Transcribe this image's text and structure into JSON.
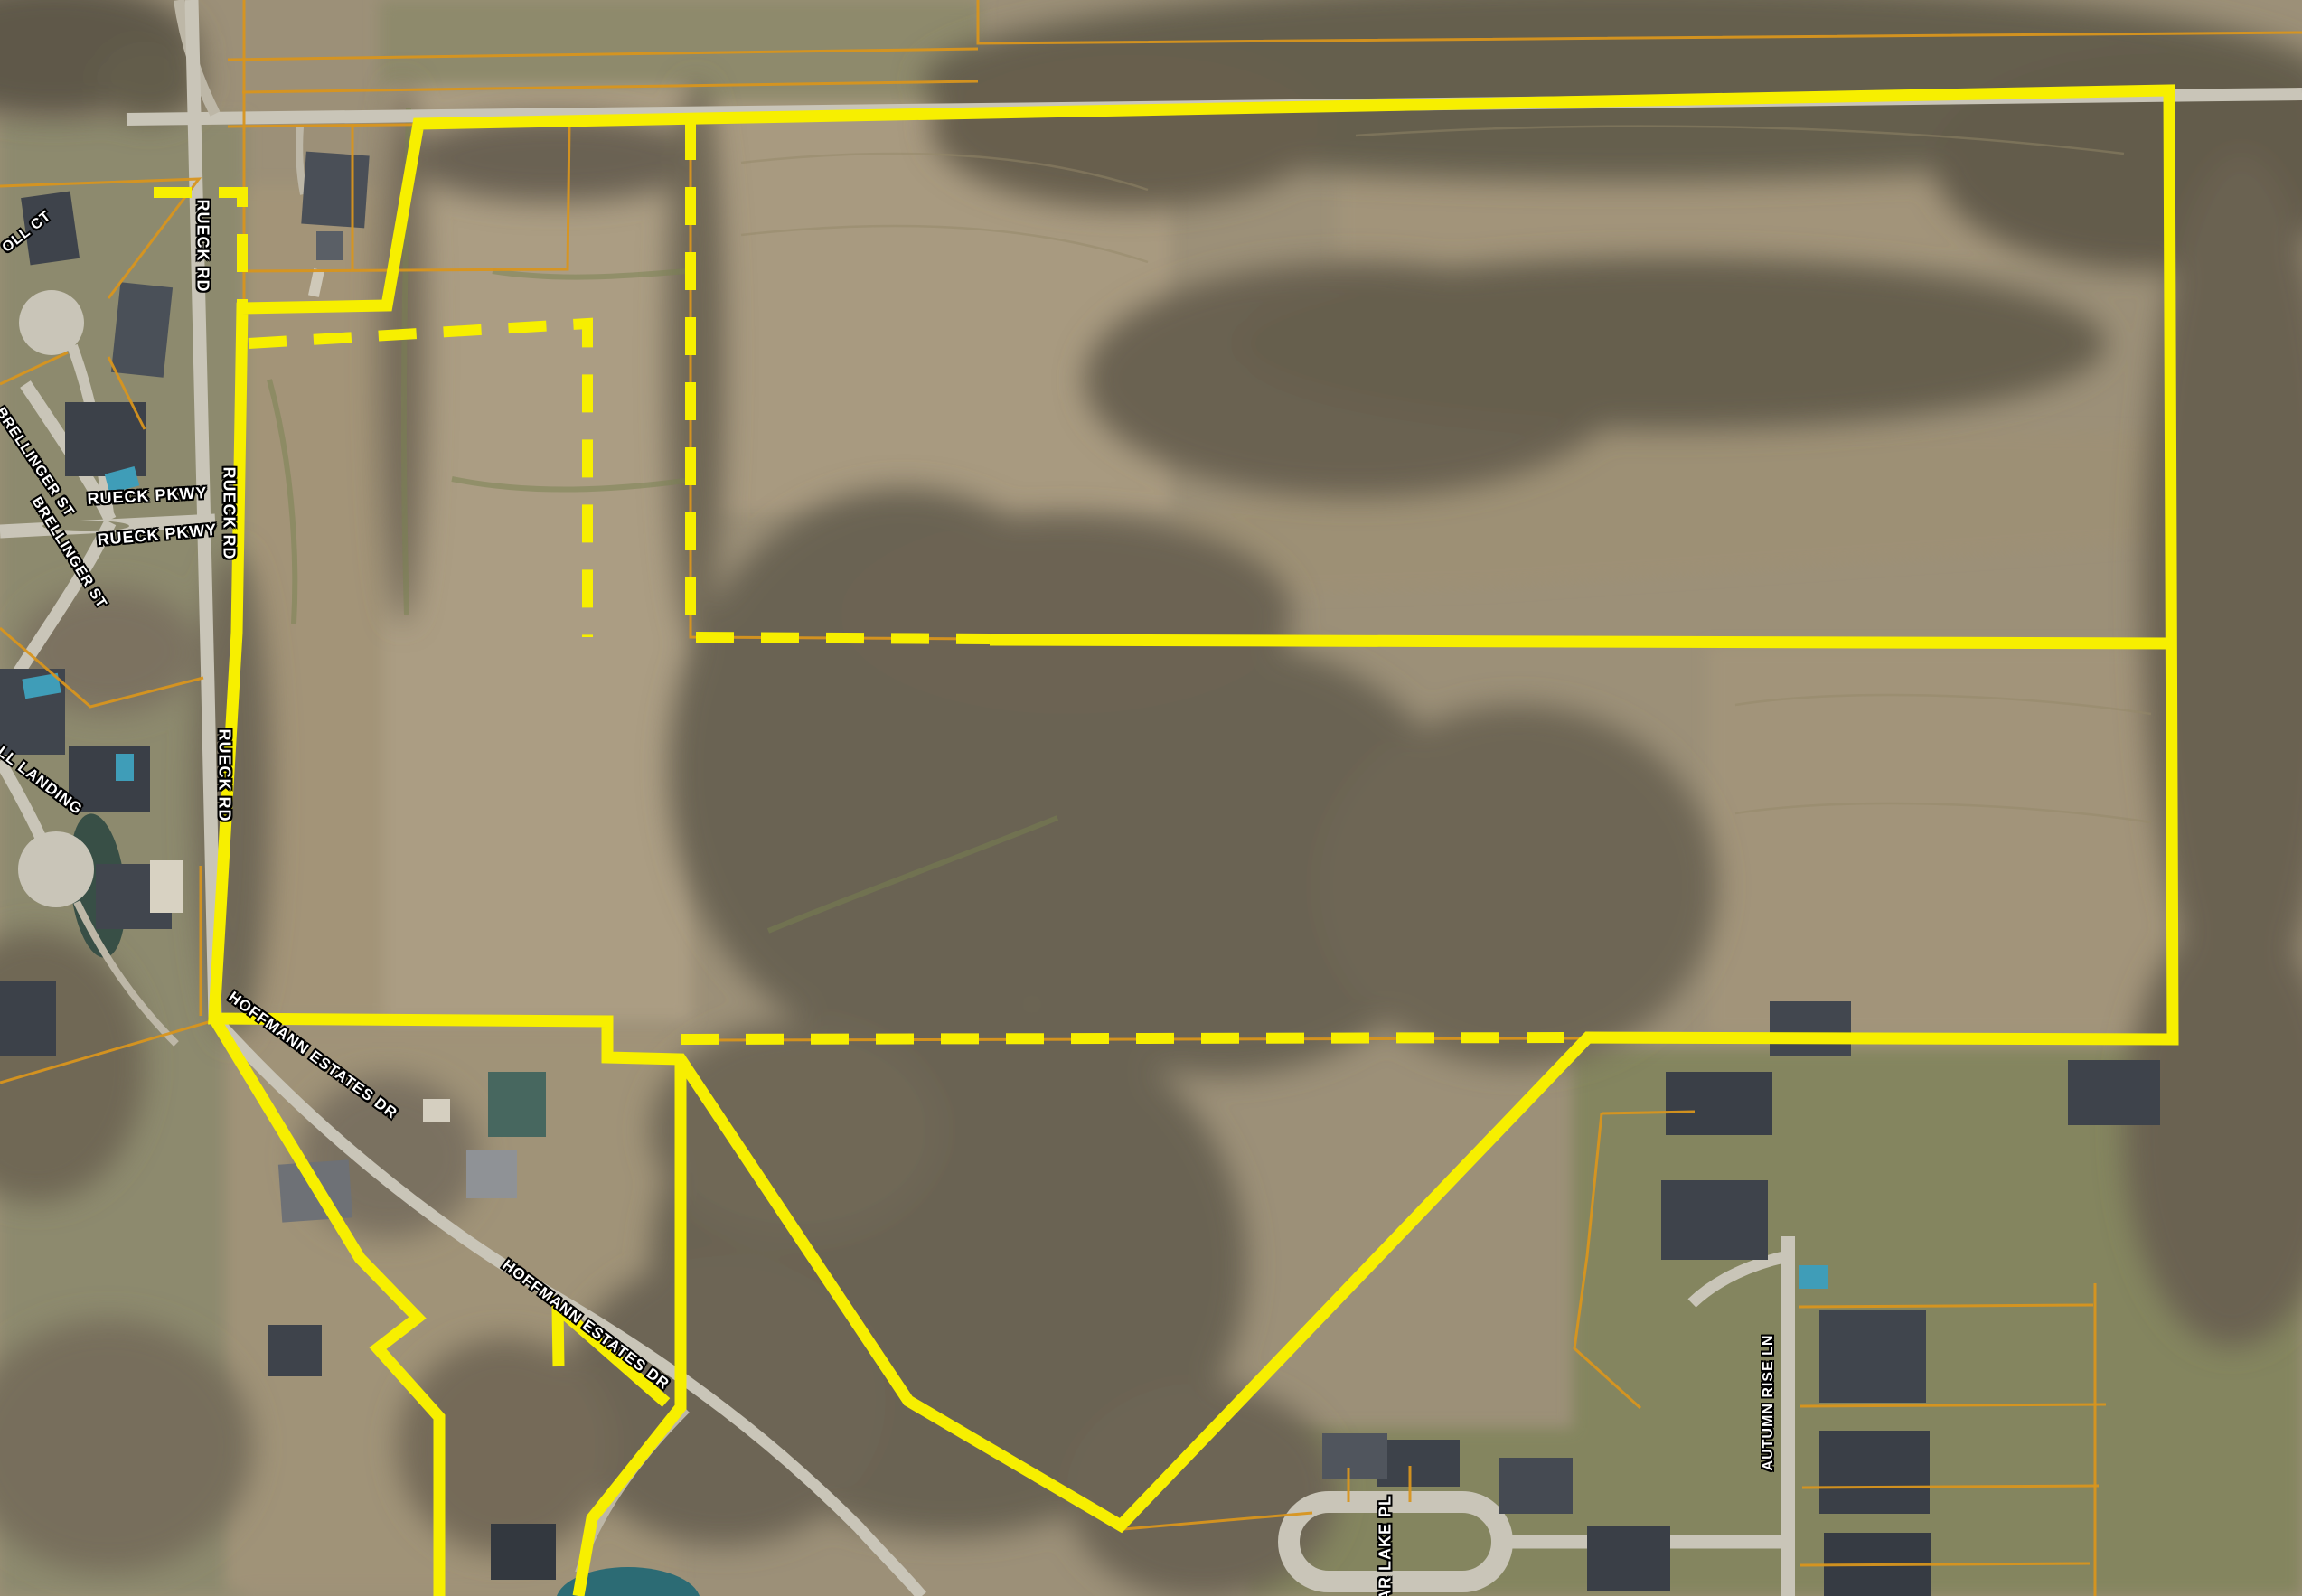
{
  "map": {
    "view": "satellite-aerial-with-parcel-boundary",
    "road_labels": [
      {
        "id": "rueck-rd-north",
        "text": "RUECK RD"
      },
      {
        "id": "oll-ct",
        "text": "OLL CT"
      },
      {
        "id": "brellinger-st-upper",
        "text": "BRELLINGER ST"
      },
      {
        "id": "brellinger-st-lower",
        "text": "BRELLINGER ST"
      },
      {
        "id": "rueck-pkwy-west",
        "text": "RUECK PKWY"
      },
      {
        "id": "rueck-pkwy-east",
        "text": "RUECK PKWY"
      },
      {
        "id": "rueck-rd-mid",
        "text": "RUECK RD"
      },
      {
        "id": "ll-landing",
        "text": "LL LANDING"
      },
      {
        "id": "rueck-rd-south",
        "text": "RUECK RD"
      },
      {
        "id": "hoffmann-estates-dr-west",
        "text": "HOFFMANN ESTATES DR"
      },
      {
        "id": "hoffmann-estates-dr-east",
        "text": "HOFFMANN ESTATES DR"
      },
      {
        "id": "autumn-rise-ln",
        "text": "AUTUMN RISE LN"
      },
      {
        "id": "briar-lake-pl-partial",
        "text": "IAR LAKE PL"
      }
    ],
    "colors": {
      "boundary_yellow": "#f7ef00",
      "parcel_line_orange": "#d8951d",
      "label_text": "#ffffff",
      "label_outline": "#000000"
    }
  }
}
